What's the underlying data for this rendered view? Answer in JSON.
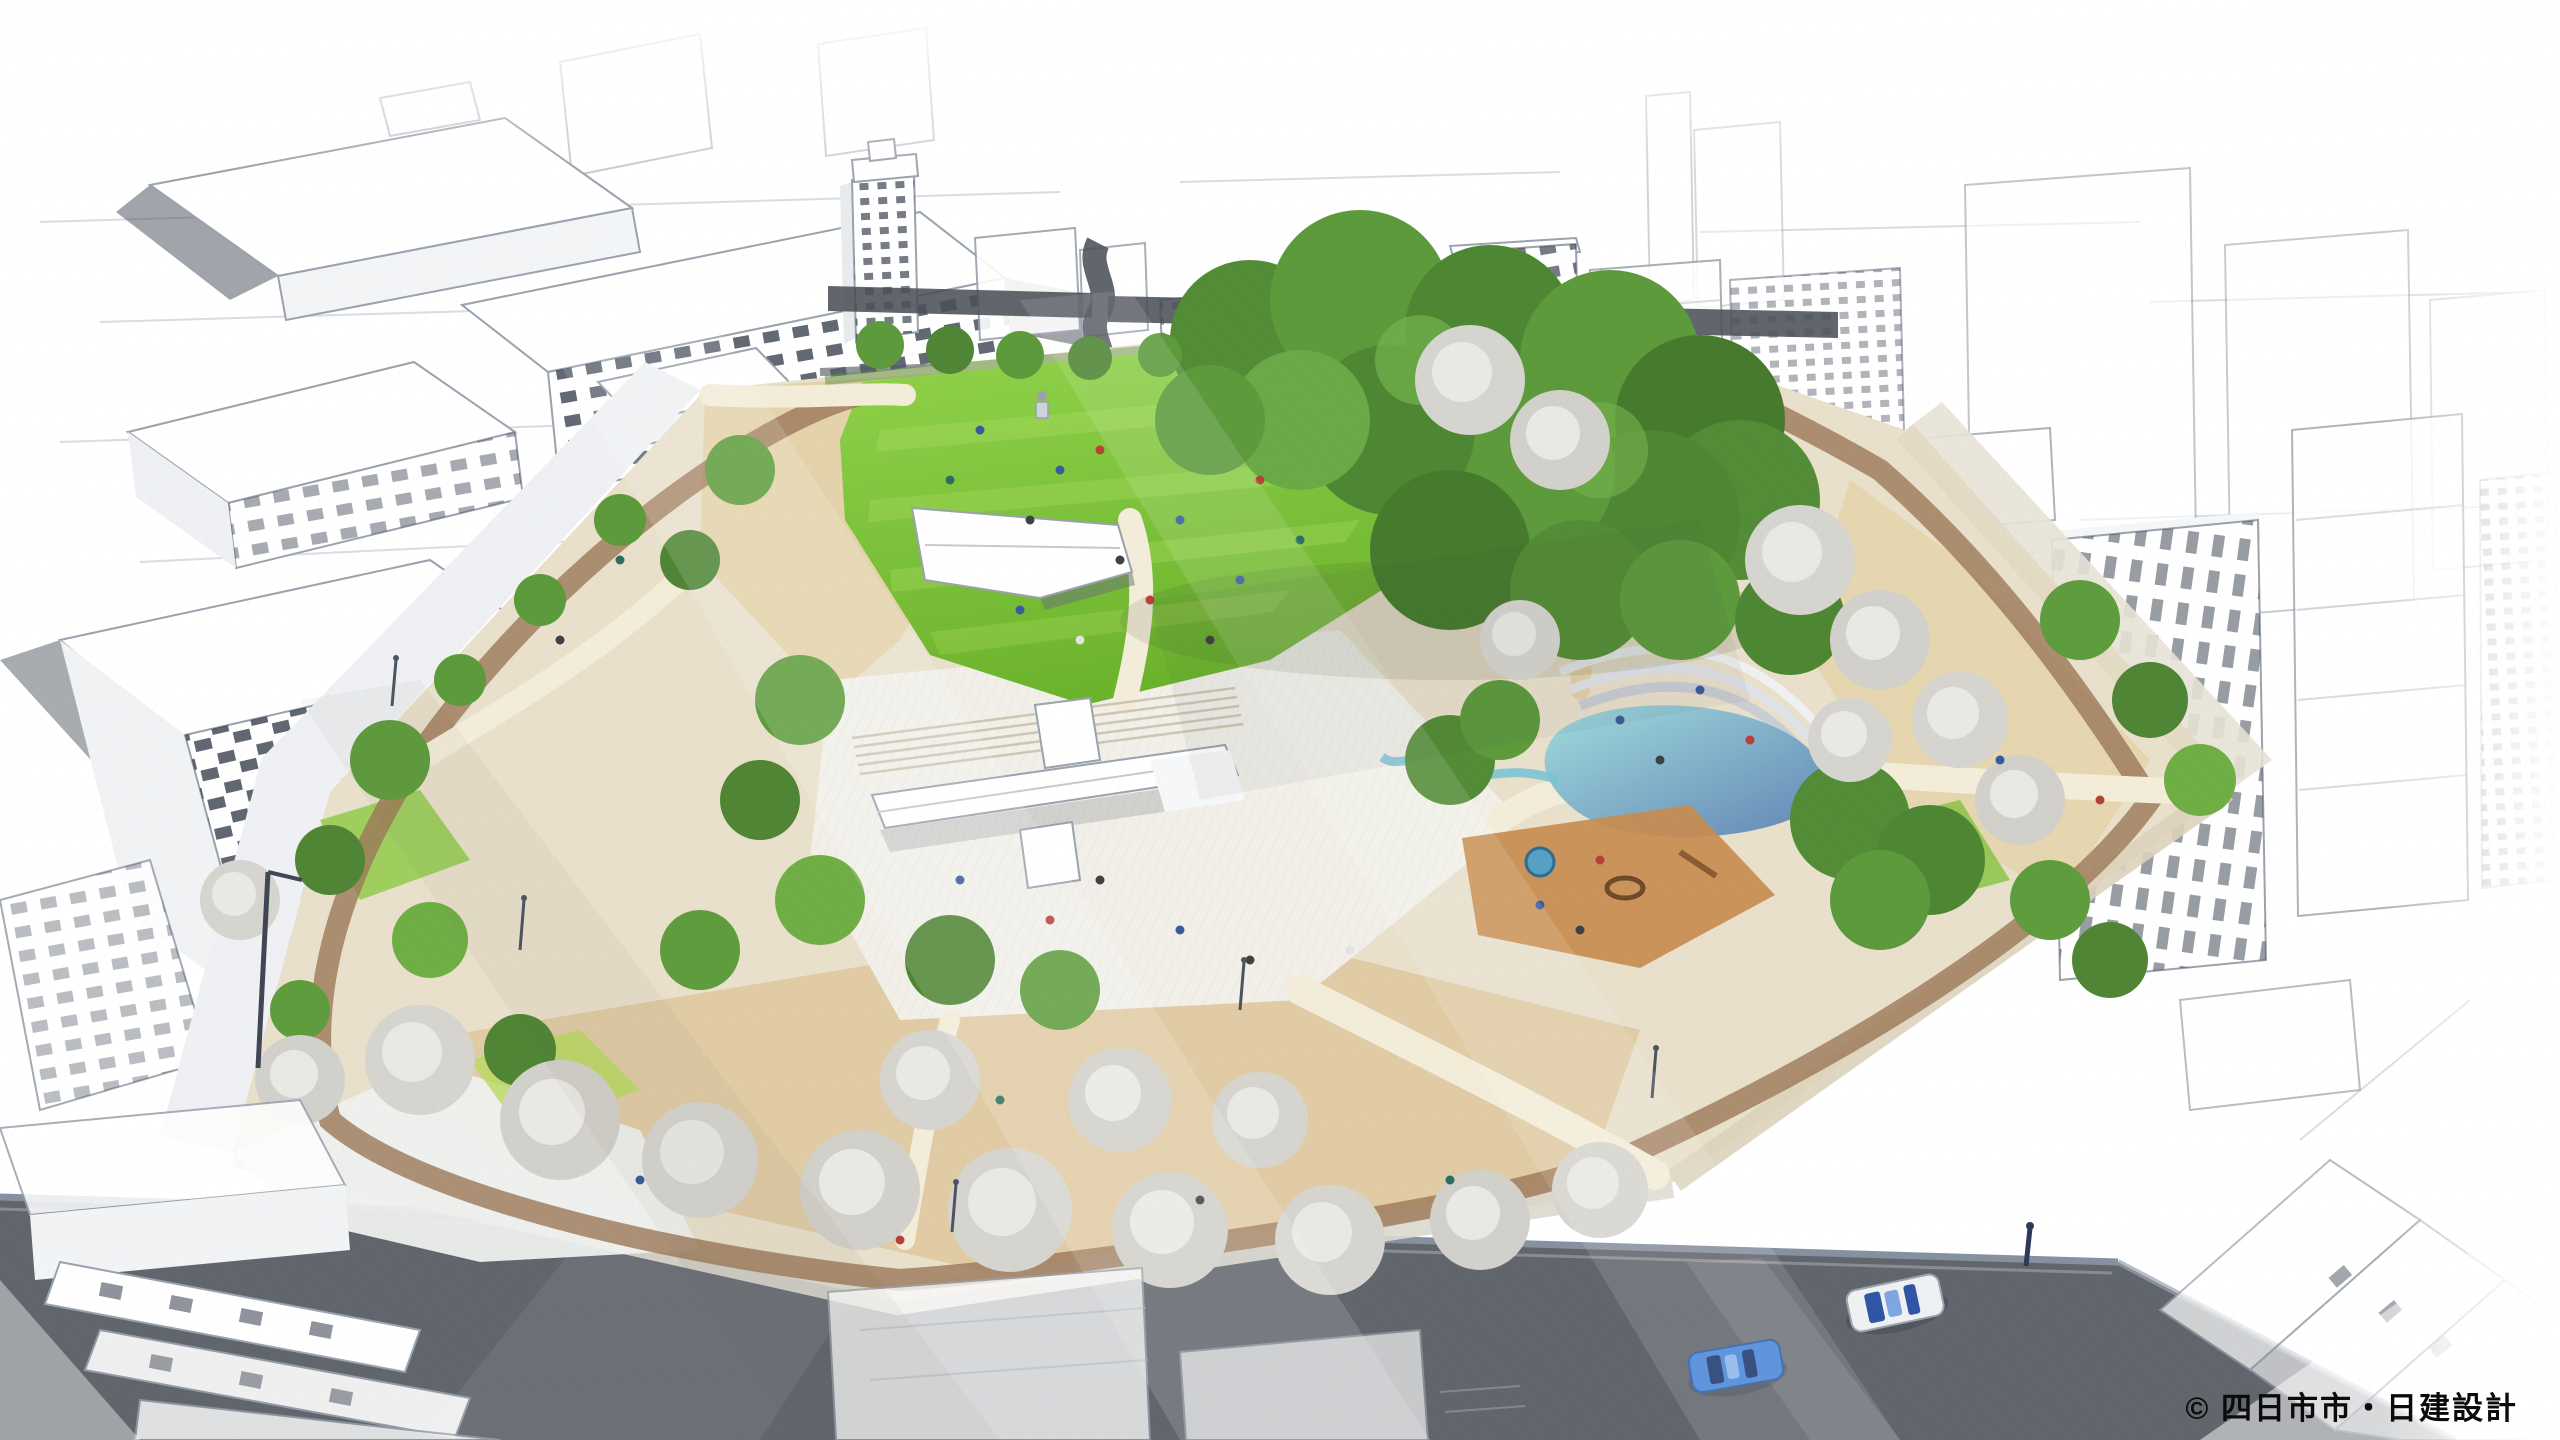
{
  "image": {
    "kind": "aerial perspective rendering",
    "subject": "park master plan surrounded by pencil-sketch city blocks",
    "credit": "© 四日市市・日建設計"
  },
  "colors": {
    "background": "#ffffff",
    "sketch_line": "#99a2ad",
    "sketch_window_dark": "#3b4452",
    "ground_cream": "#e9e0cb",
    "sand_beige": "#dfc9a0",
    "lawn_green_light": "#90d14a",
    "lawn_green_dark": "#6cb32c",
    "forest_green": "#538c36",
    "cherry_blossom_gray": "#d6d4cf",
    "loop_path_brown": "#9b7857",
    "pond_turquoise": "#9cdade",
    "pond_blue": "#5c82b4",
    "playground_orange": "#c78c4f",
    "road_dark": "#61656c",
    "curb_blue_gray": "#87909f",
    "car_blue": "#4a86d8",
    "car_white": "#eef0f2"
  },
  "scene": {
    "park_features": [
      "event-lawn",
      "white-pavilion",
      "central-building-plaza",
      "forest-grove",
      "water-terrace-pond",
      "stream",
      "playground",
      "cherry-blossom-trees",
      "loop-path",
      "street-trees",
      "statue",
      "visitors"
    ],
    "city_features": [
      "sketch-buildings-top-left",
      "sketch-buildings-top-center",
      "sketch-buildings-top-right",
      "apartment-slab-left",
      "sketch-buildings-right",
      "sketch-buildings-bottom"
    ],
    "vehicles": [
      {
        "name": "white-sedan"
      },
      {
        "name": "blue-sedan"
      }
    ]
  }
}
